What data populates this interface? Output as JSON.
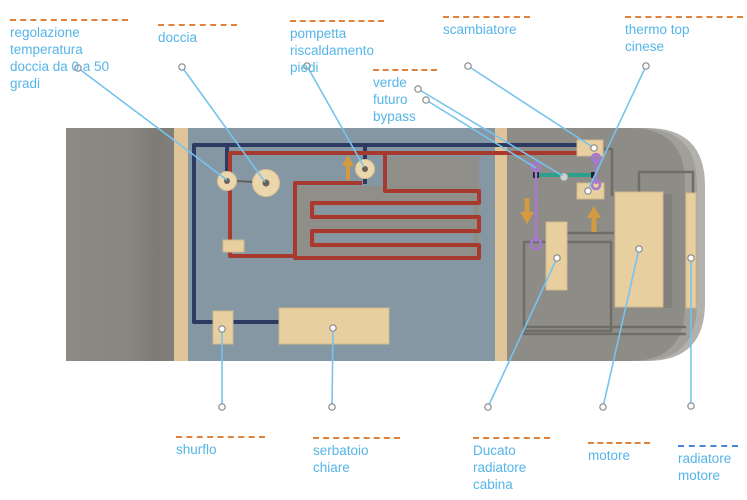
{
  "diagram_title": "camper heating and water system diagram",
  "labels": {
    "regolazione": {
      "text": "regolazione\ntemperatura\ndoccia da 0 a 50\ngradi"
    },
    "doccia": {
      "text": "doccia"
    },
    "pompetta": {
      "text": "pompetta\nriscaldamento\npiedi"
    },
    "scambiatore": {
      "text": "scambiatore"
    },
    "verde": {
      "text": "verde\nfuturo\nbypass"
    },
    "thermo": {
      "text": "thermo top\ncinese"
    },
    "shurflo": {
      "text": "shurflo"
    },
    "serbatoio": {
      "text": "serbatoio\nchiare"
    },
    "ducato": {
      "text": "Ducato\nradiatore\ncabina"
    },
    "motore": {
      "text": "motore"
    },
    "radiatore": {
      "text": "radiatore\nmotore"
    }
  },
  "colors": {
    "background": "#ffffff",
    "label_text": "#55b5e8",
    "leader": "#76c4ee",
    "overline_orange": "#e0823c",
    "overline_blue": "#4a86d8",
    "pipe_cold": "#2d3a63",
    "pipe_hot": "#a8392f",
    "bypass_green": "#2ba18c",
    "purple": "#a678d1",
    "arrow_orange": "#d39a40",
    "beige_stripe": "#dfc49a",
    "beige_part": "#e8cfa0",
    "interior": "#8697a4",
    "panel_warm": "#8f8e88",
    "body_gray": "#8e8c87",
    "rear_gray": "#888680",
    "body_rim_light": "#b3b1ac",
    "body_rim_mid": "#a19f99",
    "hose_gray": "#6f6d68"
  }
}
